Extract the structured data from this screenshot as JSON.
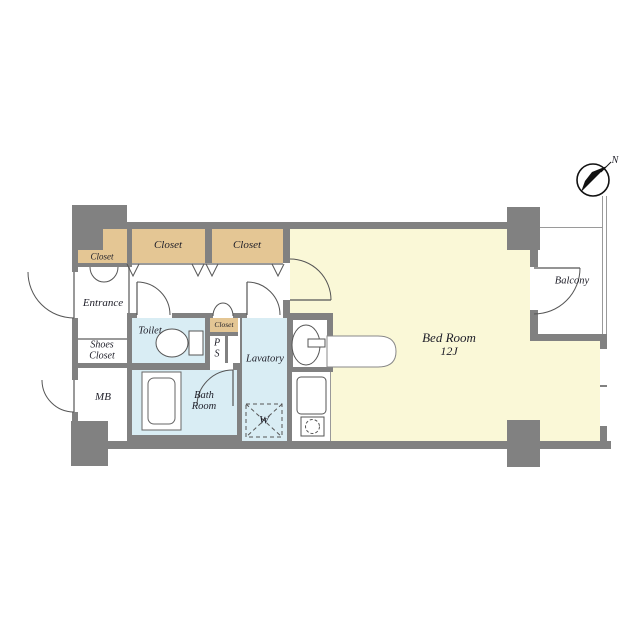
{
  "labels": {
    "closet_entrance": "Closet",
    "closet_1": "Closet",
    "closet_2": "Closet",
    "closet_mid": "Closet",
    "entrance": "Entrance",
    "shoes_1": "Shoes",
    "shoes_2": "Closet",
    "mb": "MB",
    "toilet": "Toilet",
    "ps_1": "P",
    "ps_2": "S",
    "lavatory": "Lavatory",
    "bath_1": "Bath",
    "bath_2": "Room",
    "washer": "W",
    "bedroom_name": "Bed Room",
    "bedroom_size": "12J",
    "balcony": "Balcony",
    "compass_north": "N"
  },
  "colors": {
    "wall": "#818181",
    "closet_fill": "#e4c694",
    "bedroom_fill": "#faf8d7",
    "wet_room_fill": "#d9edf4",
    "floor": "#ffffff",
    "line": "#555555"
  }
}
